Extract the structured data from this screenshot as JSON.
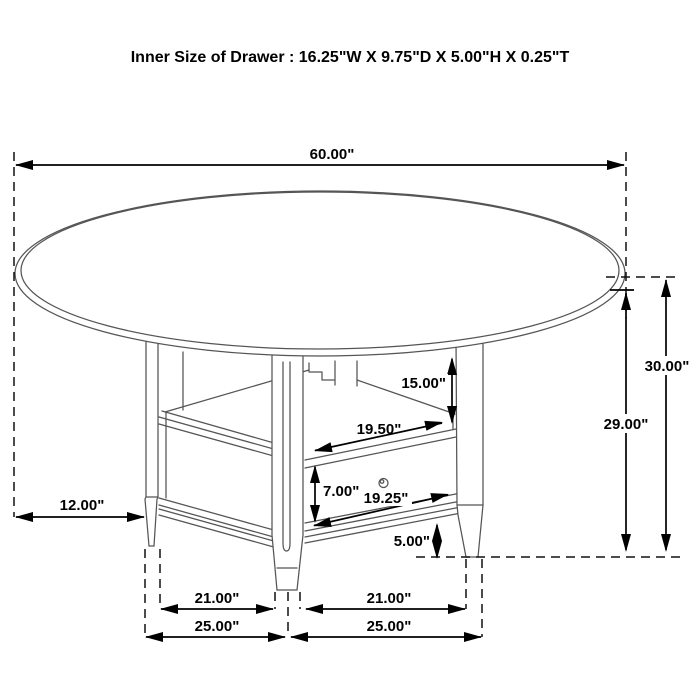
{
  "title": "Inner Size of Drawer : 16.25\"W X 9.75\"D X 5.00\"H X 0.25\"T",
  "dimensions": {
    "tabletop_diameter": "60.00\"",
    "overall_height": "30.00\"",
    "underside_height": "29.00\"",
    "top_to_shelf": "15.00\"",
    "shelf_opening_width": "19.50\"",
    "drawer_height": "7.00\"",
    "drawer_width": "19.25\"",
    "bottom_clearance": "5.00\"",
    "top_overhang": "12.00\"",
    "inner_span_left": "21.00\"",
    "inner_span_right": "21.00\"",
    "outer_span_left": "25.00\"",
    "outer_span_right": "25.00\""
  },
  "colors": {
    "dimension_line": "#000000",
    "drawing_line": "#555555",
    "background": "#ffffff"
  }
}
